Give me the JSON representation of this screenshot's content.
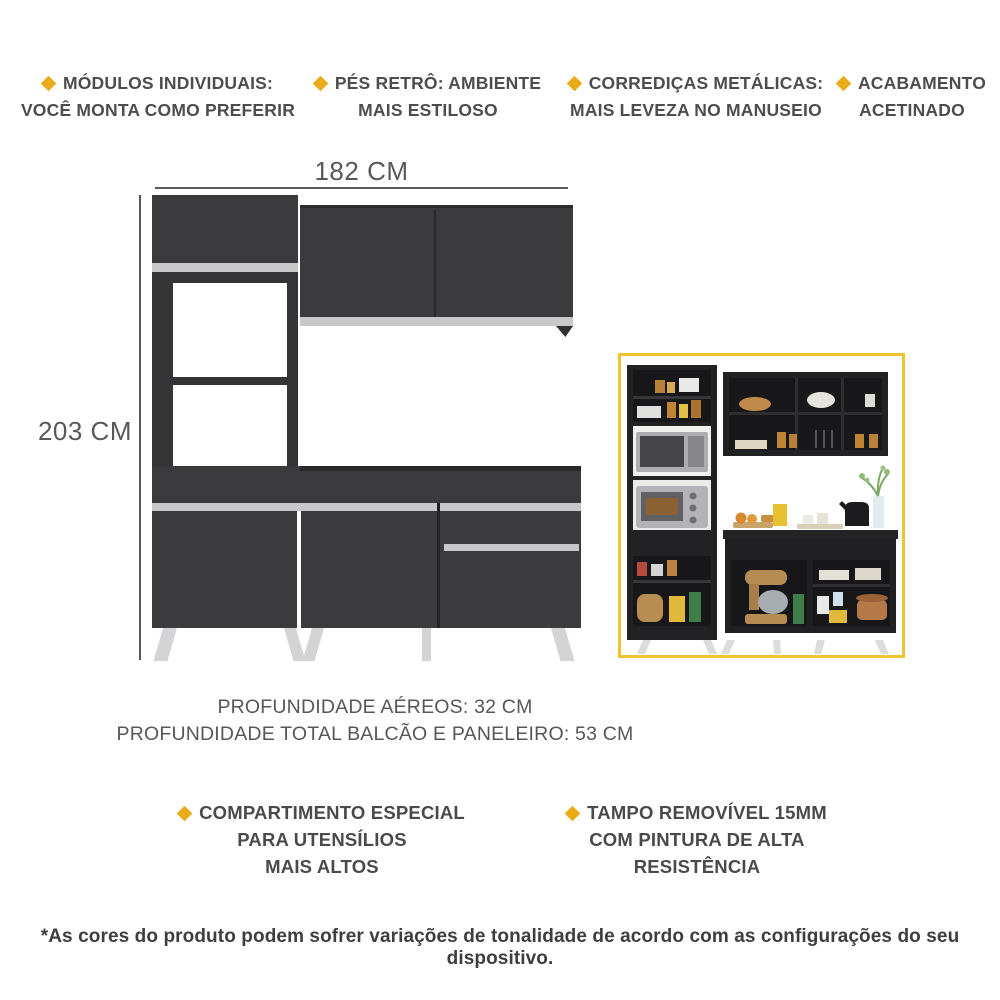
{
  "features_top": [
    {
      "line1": "MÓDULOS INDIVIDUAIS:",
      "line2": "VOCÊ MONTA COMO PREFERIR"
    },
    {
      "line1": "PÉS RETRÔ: AMBIENTE",
      "line2": "MAIS ESTILOSO"
    },
    {
      "line1": "CORREDIÇAS METÁLICAS:",
      "line2": "MAIS LEVEZA NO MANUSEIO"
    },
    {
      "line1": "ACABAMENTO",
      "line2": "ACETINADO"
    }
  ],
  "dimensions": {
    "width_label": "182 CM",
    "height_label": "203 CM"
  },
  "depth_info": {
    "line1": "PROFUNDIDADE AÉREOS: 32 CM",
    "line2": "PROFUNDIDADE TOTAL BALCÃO E PANELEIRO: 53 CM"
  },
  "features_bottom": [
    {
      "lines": [
        "COMPARTIMENTO ESPECIAL",
        "PARA UTENSÍLIOS",
        "MAIS ALTOS"
      ]
    },
    {
      "lines": [
        "TAMPO REMOVÍVEL 15MM",
        "COM PINTURA DE ALTA",
        "RESISTÊNCIA"
      ]
    }
  ],
  "disclaimer": "*As cores do produto podem sofrer variações de tonalidade de acordo com as configurações do seu dispositivo.",
  "icons": {
    "bullet": "diamond-icon"
  },
  "colors": {
    "bullet": "#E9AC18",
    "cabinet_dark": "#3B3B3D",
    "cabinet_edge": "#29292B",
    "handle_strip": "#C8C8CA",
    "legs": "#D4D4D6",
    "inset_border": "#EFC42F",
    "dimension": "#58585A",
    "feature_text": "#4D4D4F",
    "depth_text": "#57575A",
    "disclaimer_text": "#3E3E40"
  }
}
